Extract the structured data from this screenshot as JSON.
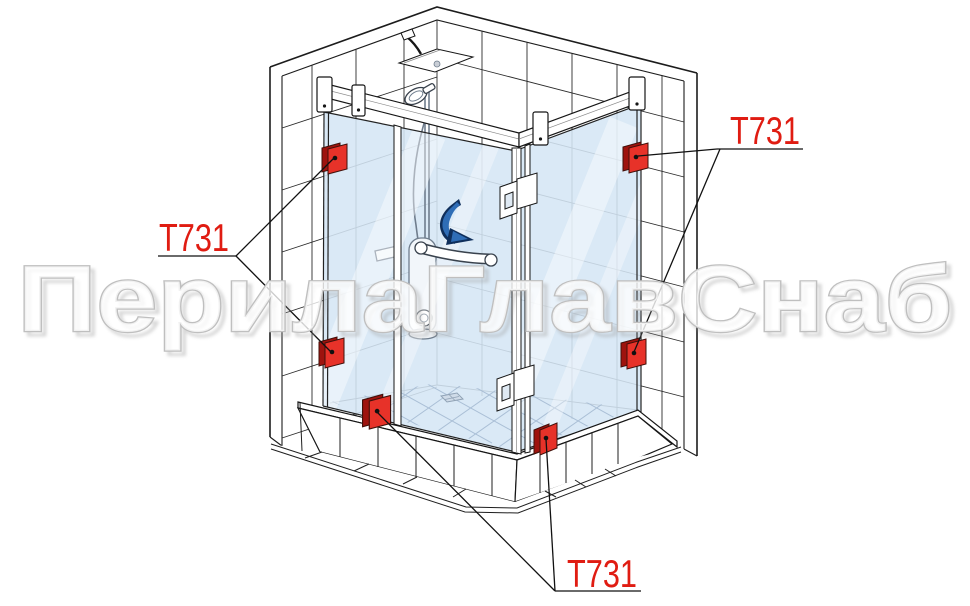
{
  "diagram": {
    "watermark_text": "ПерилаГлавСнаб",
    "labels": {
      "left": "T731",
      "top_right": "T731",
      "bottom": "T731"
    },
    "subject": "corner glass shower enclosure installation diagram",
    "callout_part_number": "T731",
    "callout_count": 3,
    "clamp_count": 6,
    "colors": {
      "label_red": "#e01c12",
      "clamp_red": "#e73229",
      "clamp_red_dark": "#9e130e",
      "clamp_outline": "#40100a",
      "arrow_blue": "#2f6db6",
      "arrow_navy": "#0f2f5c",
      "glass_tint": "#d5e6f5",
      "line_dark": "#1c1c1c",
      "fixture_gray": "#6f7d8d",
      "floor_line": "#aabfd6",
      "watermark_fill": "#ffffff",
      "watermark_stroke": "#bfbfbf"
    }
  }
}
